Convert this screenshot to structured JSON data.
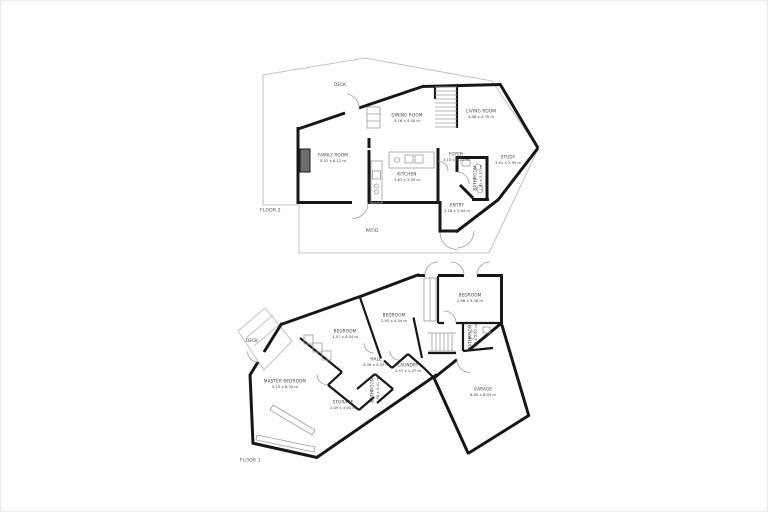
{
  "plan": {
    "wall_color": "#171717",
    "outline_color": "#c6c6c6",
    "detail_color": "#9c9c9c",
    "label_color": "#3f3f3f",
    "background_color": "#ffffff",
    "floors": [
      {
        "id": "floor-2",
        "label": "FLOOR 2",
        "label_pos": {
          "x": 259,
          "y": 209
        },
        "rooms": [
          {
            "name": "DECK",
            "dims": "",
            "x": 339,
            "y": 84,
            "vertical": false
          },
          {
            "name": "DINING ROOM",
            "dims": "5.16 x 4.40 m",
            "x": 406,
            "y": 117,
            "vertical": false
          },
          {
            "name": "LIVING ROOM",
            "dims": "4.06 x 4.70 m",
            "x": 480,
            "y": 113,
            "vertical": false
          },
          {
            "name": "FAMILY ROOM",
            "dims": "5.31 x 6.12 m",
            "x": 332,
            "y": 157,
            "vertical": false
          },
          {
            "name": "KITCHEN",
            "dims": "3.67 x 3.59 m",
            "x": 406,
            "y": 176,
            "vertical": false
          },
          {
            "name": "FOYER",
            "dims": "3.15 x 3.21 m",
            "x": 455,
            "y": 156,
            "vertical": false
          },
          {
            "name": "STUDY",
            "dims": "3.91 x 2.95 m",
            "x": 507,
            "y": 159,
            "vertical": false
          },
          {
            "name": "BATHROOM",
            "dims": "1.91 x 2.21 m",
            "x": 477,
            "y": 177,
            "vertical": true
          },
          {
            "name": "ENTRY",
            "dims": "3.16 x 2.94 m",
            "x": 456,
            "y": 207,
            "vertical": false
          },
          {
            "name": "PATIO",
            "dims": "",
            "x": 371,
            "y": 230,
            "vertical": false
          }
        ]
      },
      {
        "id": "floor-1",
        "label": "FLOOR 1",
        "label_pos": {
          "x": 239,
          "y": 459
        },
        "rooms": [
          {
            "name": "DECK",
            "dims": "",
            "x": 251,
            "y": 340,
            "vertical": false
          },
          {
            "name": "MASTER BEDROOM",
            "dims": "5.15 x 6.34 m",
            "x": 284,
            "y": 383,
            "vertical": false
          },
          {
            "name": "BEDROOM",
            "dims": "3.47 x 4.04 m",
            "x": 344,
            "y": 333,
            "vertical": false
          },
          {
            "name": "BEDROOM",
            "dims": "2.95 x 4.04 m",
            "x": 393,
            "y": 317,
            "vertical": false
          },
          {
            "name": "BEDROOM",
            "dims": "2.96 x 3.58 m",
            "x": 469,
            "y": 297,
            "vertical": false
          },
          {
            "name": "HALL",
            "dims": "4.39 x 3.33 m",
            "x": 375,
            "y": 361,
            "vertical": false
          },
          {
            "name": "LAUNDRY",
            "dims": "2.57 x 1.47 m",
            "x": 407,
            "y": 367,
            "vertical": false
          },
          {
            "name": "BATHROOM",
            "dims": "1.58 x 3.41 m",
            "x": 374,
            "y": 389,
            "vertical": true
          },
          {
            "name": "BATHROOM",
            "dims": "1.37 x 2.27 m",
            "x": 472,
            "y": 336,
            "vertical": true
          },
          {
            "name": "STORAGE",
            "dims": "2.09 x 3.04 m",
            "x": 342,
            "y": 404,
            "vertical": false
          },
          {
            "name": "GARAGE",
            "dims": "8.05 x 6.03 m",
            "x": 482,
            "y": 391,
            "vertical": false
          }
        ]
      }
    ]
  }
}
